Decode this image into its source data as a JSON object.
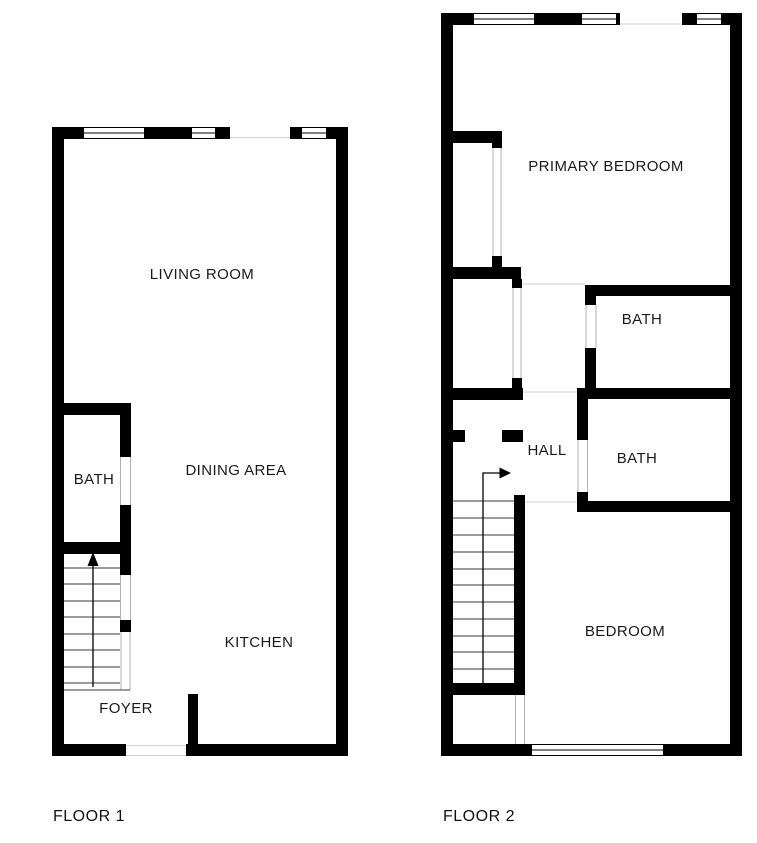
{
  "page": {
    "width": 757,
    "height": 843,
    "background": "#ffffff"
  },
  "colors": {
    "wall": "#000000",
    "window_fill": "#ffffff",
    "window_frame": "#000000",
    "jamb": "#b0b0b0",
    "boundary": "#cfcfcf",
    "tread": "#3a3a3a",
    "arrow": "#000000"
  },
  "floors": [
    {
      "name": "FLOOR 1",
      "label_anchor": {
        "x": 53,
        "y": 821
      },
      "rooms": [
        {
          "label": "LIVING ROOM",
          "x": 202,
          "y": 274
        },
        {
          "label": "BATH",
          "x": 94,
          "y": 479
        },
        {
          "label": "DINING AREA",
          "x": 236,
          "y": 470
        },
        {
          "label": "KITCHEN",
          "x": 259,
          "y": 642
        },
        {
          "label": "FOYER",
          "x": 126,
          "y": 708
        }
      ],
      "walls": [
        [
          52,
          127,
          12,
          629
        ],
        [
          336,
          127,
          12,
          629
        ],
        [
          52,
          127,
          28,
          12
        ],
        [
          148,
          127,
          40,
          12
        ],
        [
          219,
          127,
          11,
          12
        ],
        [
          290,
          127,
          8,
          12
        ],
        [
          330,
          127,
          18,
          12
        ],
        [
          52,
          744,
          74,
          12
        ],
        [
          186,
          744,
          162,
          12
        ],
        [
          52,
          403,
          77,
          12
        ],
        [
          120,
          403,
          11,
          54
        ],
        [
          120,
          505,
          11,
          49
        ],
        [
          52,
          542,
          77,
          12
        ],
        [
          120,
          542,
          11,
          33
        ],
        [
          120,
          620,
          11,
          12
        ],
        [
          188,
          694,
          10,
          62
        ]
      ],
      "windows": [
        [
          80,
          127,
          68,
          12
        ],
        [
          188,
          127,
          31,
          12
        ],
        [
          298,
          127,
          32,
          12
        ]
      ],
      "boundary_lines": [
        [
          230,
          137.5,
          290,
          137.5
        ],
        [
          126,
          745.5,
          186,
          745.5
        ],
        [
          126,
          755.5,
          186,
          755.5
        ]
      ],
      "jamb_lines": [
        [
          120.5,
          457,
          120.5,
          505
        ],
        [
          130.5,
          457,
          130.5,
          505
        ],
        [
          120.5,
          575,
          120.5,
          620
        ],
        [
          130.5,
          575,
          130.5,
          620
        ],
        [
          121,
          632,
          121,
          690
        ],
        [
          130,
          632,
          130,
          690
        ]
      ],
      "stairs": {
        "x1": 63,
        "x2": 120,
        "tread_ys": [
          568,
          584,
          601,
          617,
          634,
          650,
          667,
          683
        ]
      },
      "stair_lines": [
        [
          63,
          690,
          130,
          690
        ]
      ],
      "arrow": {
        "points": "93,687 93,566",
        "head": "93,552 87.5,566 98.5,566"
      }
    },
    {
      "name": "FLOOR 2",
      "label_anchor": {
        "x": 443,
        "y": 821
      },
      "rooms": [
        {
          "label": "PRIMARY BEDROOM",
          "x": 606,
          "y": 166
        },
        {
          "label": "BATH",
          "x": 642,
          "y": 319
        },
        {
          "label": "HALL",
          "x": 547,
          "y": 450
        },
        {
          "label": "BATH",
          "x": 637,
          "y": 458
        },
        {
          "label": "BEDROOM",
          "x": 625,
          "y": 631
        }
      ],
      "walls": [
        [
          441,
          13,
          12,
          743
        ],
        [
          730,
          13,
          12,
          743
        ],
        [
          441,
          13,
          29,
          12
        ],
        [
          538,
          13,
          40,
          12
        ],
        [
          682,
          13,
          11,
          12
        ],
        [
          725,
          13,
          17,
          12
        ],
        [
          441,
          744,
          87,
          12
        ],
        [
          667,
          744,
          75,
          12
        ],
        [
          441,
          131,
          61,
          12
        ],
        [
          492,
          131,
          10,
          17
        ],
        [
          492,
          256,
          10,
          12
        ],
        [
          441,
          267,
          80,
          12
        ],
        [
          512,
          279,
          10,
          9
        ],
        [
          512,
          378,
          10,
          11
        ],
        [
          441,
          388,
          82,
          12
        ],
        [
          441,
          430,
          24,
          12
        ],
        [
          502,
          430,
          21,
          12
        ],
        [
          514,
          495,
          11,
          200
        ],
        [
          453,
          683,
          72,
          12
        ],
        [
          585,
          285,
          157,
          11
        ],
        [
          585,
          295,
          11,
          10
        ],
        [
          585,
          348,
          11,
          40
        ],
        [
          577,
          388,
          165,
          11
        ],
        [
          577,
          398,
          11,
          42
        ],
        [
          577,
          492,
          11,
          17
        ],
        [
          577,
          501,
          165,
          11
        ]
      ],
      "windows": [
        [
          470,
          13,
          68,
          12
        ],
        [
          578,
          13,
          42,
          12
        ],
        [
          693,
          13,
          32,
          12
        ],
        [
          528,
          744,
          139,
          12
        ]
      ],
      "boundary_lines": [
        [
          620,
          24,
          682,
          24
        ],
        [
          520,
          284,
          585,
          284
        ],
        [
          521,
          392,
          577,
          392
        ],
        [
          525,
          502,
          577,
          502
        ]
      ],
      "jamb_lines": [
        [
          493,
          148,
          493,
          256
        ],
        [
          501,
          148,
          501,
          256
        ],
        [
          513,
          287,
          513,
          378
        ],
        [
          521,
          287,
          521,
          378
        ],
        [
          586,
          305,
          586,
          348
        ],
        [
          596,
          305,
          596,
          348
        ],
        [
          578,
          440,
          578,
          492
        ],
        [
          587.5,
          440,
          587.5,
          492
        ],
        [
          515.5,
          695,
          515.5,
          744
        ],
        [
          524.5,
          695,
          524.5,
          744
        ]
      ],
      "stairs": {
        "x1": 453,
        "x2": 514,
        "tread_ys": [
          501,
          518,
          535,
          552,
          569,
          585,
          602,
          619,
          636,
          652,
          669
        ]
      },
      "stair_lines": [],
      "arrow": {
        "points": "483,683 483,473 501,473",
        "head": "511,473 499.5,467.5 499.5,478.5"
      }
    }
  ]
}
